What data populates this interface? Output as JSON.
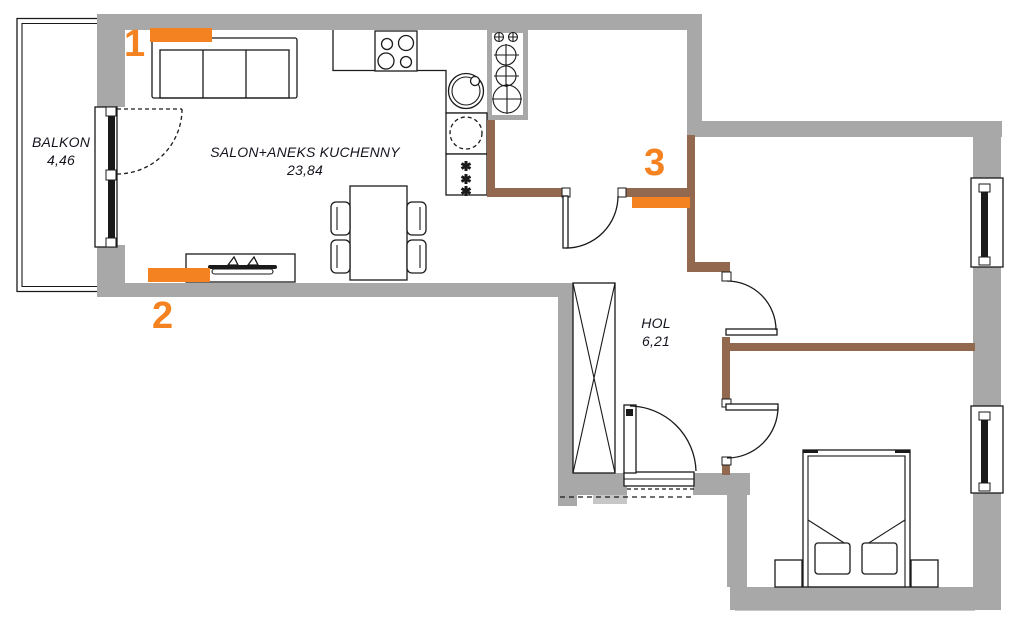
{
  "colors": {
    "wall_gray": "#a8a8a8",
    "partition_brown": "#92694e",
    "marker_orange": "#f58220",
    "line_black": "#1a1a1a"
  },
  "rooms": {
    "balkon": {
      "name": "BALKON",
      "area": "4,46"
    },
    "salon": {
      "name": "SALON+ANEKS KUCHENNY",
      "area": "23,84"
    },
    "hol": {
      "name": "HOL",
      "area": "6,21"
    }
  },
  "markers": [
    {
      "label": "1"
    },
    {
      "label": "2"
    },
    {
      "label": "3"
    }
  ],
  "furniture_icons": [
    "sofa-icon",
    "tv-console-icon",
    "dining-table-icon",
    "chair-icon",
    "cooktop-icon",
    "sink-icon",
    "washing-machine-icon",
    "fridge-icon",
    "riser-shaft-icon",
    "wardrobe-icon",
    "bed-icon",
    "nightstand-icon",
    "window-icon",
    "door-swing-icon"
  ]
}
